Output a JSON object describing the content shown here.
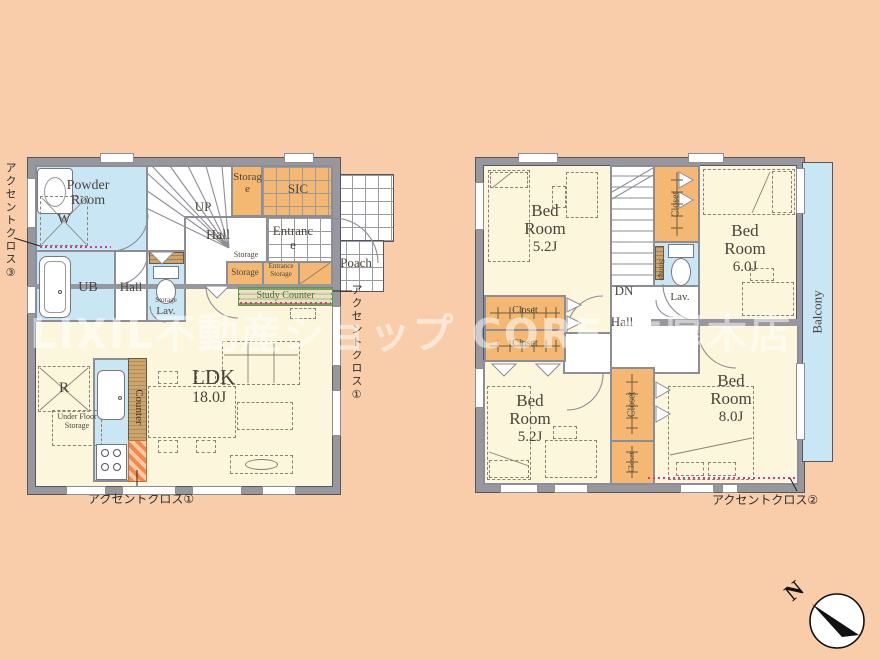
{
  "watermark": "LIXIL不動産ショップ CORE 本厚木店",
  "annotations": {
    "accent_left": "アクセントクロス③",
    "accent_right": "アクセントクロス①",
    "accent_bottom_1f": "アクセントクロス①",
    "accent_bottom_2f": "アクセントクロス②",
    "north": "N"
  },
  "floor1": {
    "powder_room": "Powder Room",
    "washer": "W",
    "bath": "UB",
    "hall_left": "Hall",
    "lav": "Lav.",
    "lav_storage": "Storage",
    "stairs_up": "UP",
    "hall": "Hall",
    "storage_top": "Storage",
    "sic": "SIC",
    "entrance": "Entrance",
    "porch": "Poach",
    "storage_text": "Storage",
    "storage_cabinet": "Storage",
    "entrance_storage": "Entrance Storage",
    "study_counter": "Study Counter",
    "ldk_name": "LDK",
    "ldk_size": "18.0J",
    "kitchen_counter": "Counter",
    "fridge": "R",
    "under_floor_storage": "Under Floor Storage"
  },
  "floor2": {
    "bed1": {
      "name": "Bed Room",
      "size": "5.2J"
    },
    "bed2": {
      "name": "Bed Room",
      "size": "6.0J"
    },
    "bed3": {
      "name": "Bed Room",
      "size": "8.0J"
    },
    "bed4": {
      "name": "Bed Room",
      "size": "5.2J"
    },
    "stairs_dn": "DN",
    "hall": "Hall",
    "lav": "Lav.",
    "lav_storage": "Storage",
    "closet_label": "Closet",
    "balcony": "Balcony"
  },
  "colors": {
    "background": "#F9CDA9",
    "room_floor": "#FBF6DC",
    "water_blue": "#C9E6F4",
    "closet_orange": "#F5B873",
    "wall_gray": "#97979F",
    "accent_magenta": "#EC2E8F",
    "wood_tan": "#CBA56D",
    "study_green": "#6D8F50"
  }
}
